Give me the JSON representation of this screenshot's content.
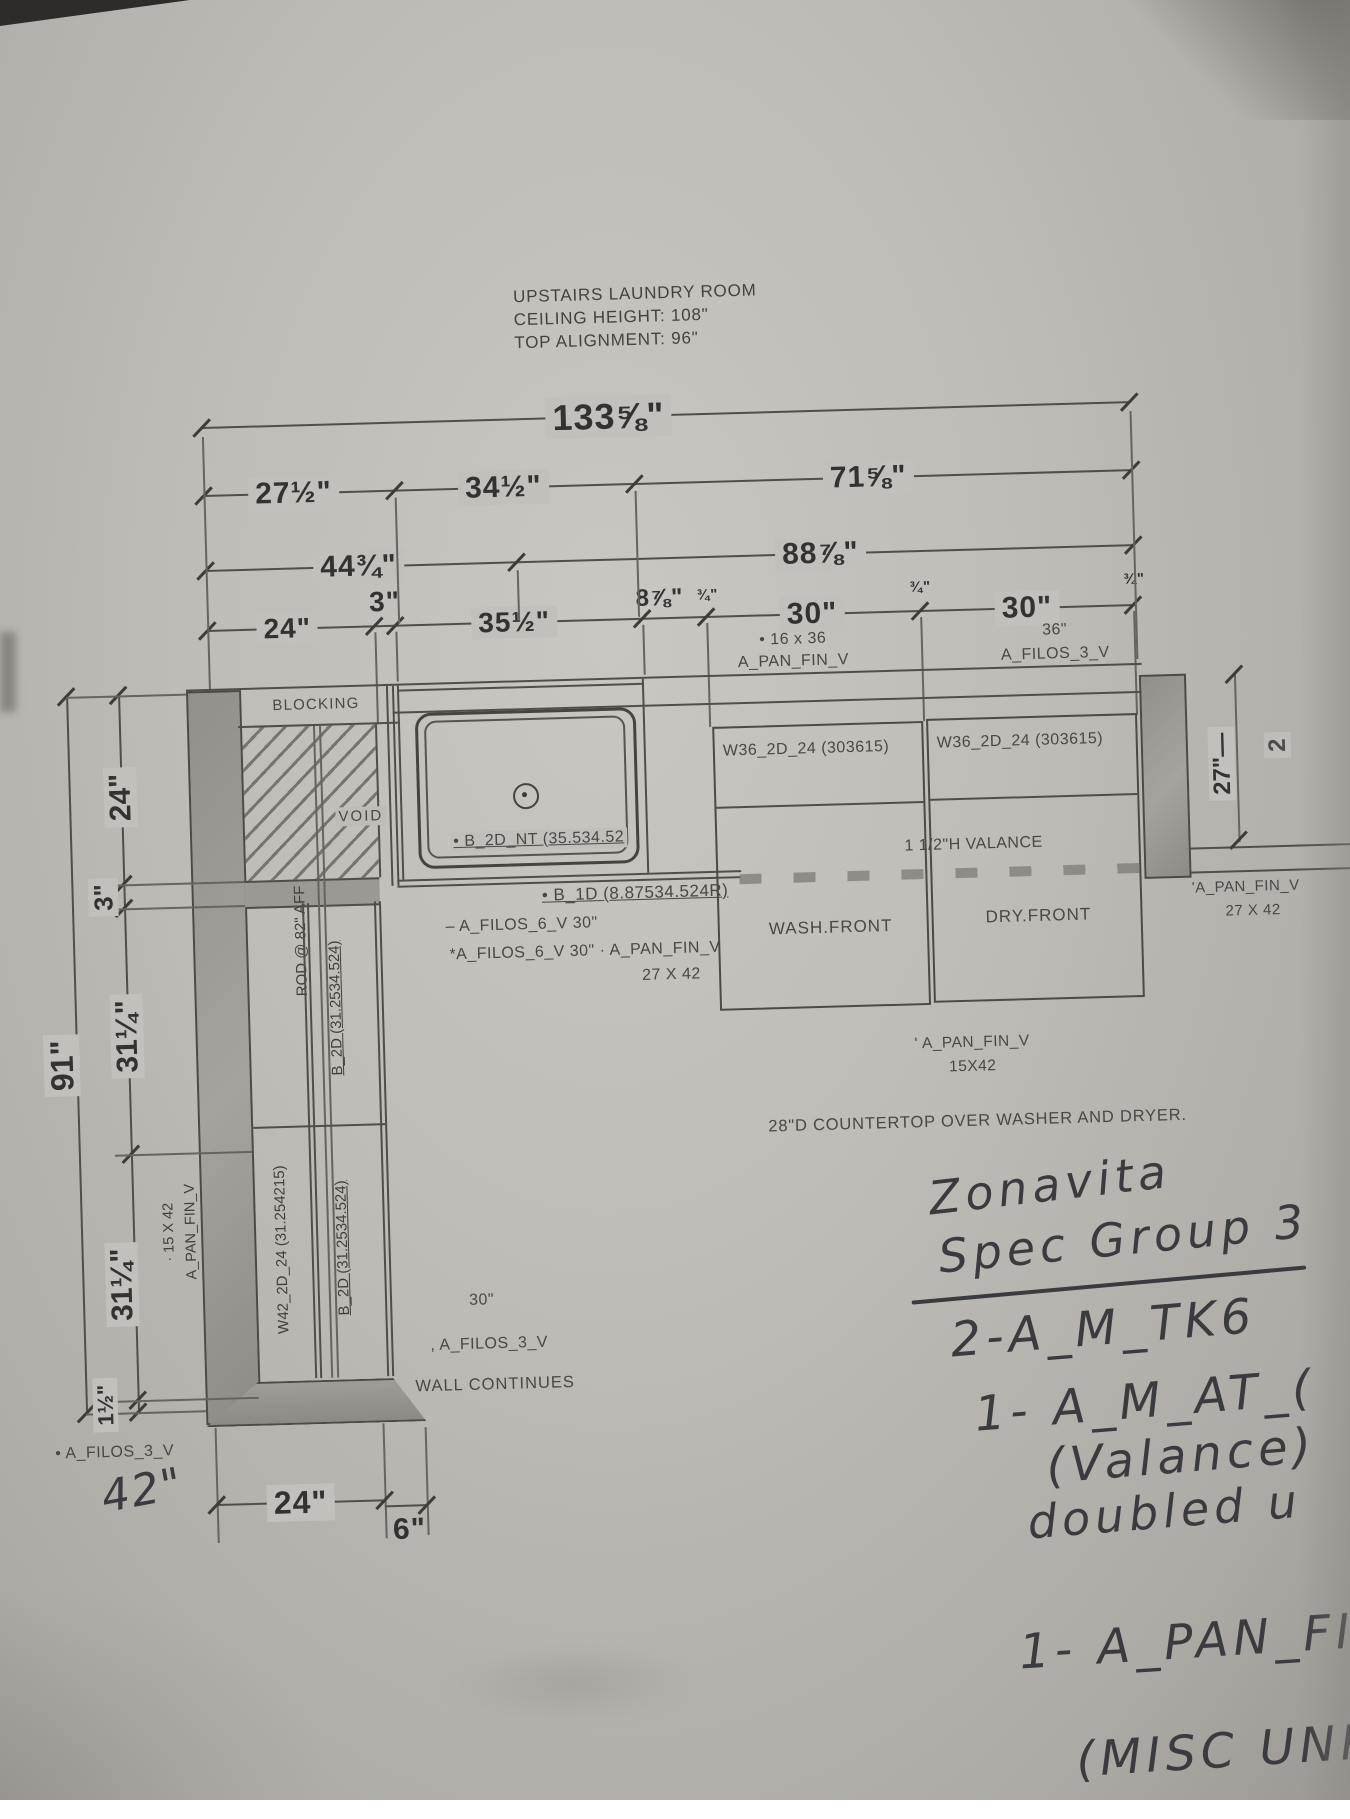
{
  "colors": {
    "paper": "#bfbcb7",
    "ink": "#45423e",
    "pencil": "#3a3a3f",
    "wall_fill": "#97938e"
  },
  "title_block": {
    "line1": "UPSTAIRS LAUNDRY ROOM",
    "line2": "CEILING HEIGHT: 108\"",
    "line3": "TOP ALIGNMENT: 96\""
  },
  "top_dims": {
    "overall": "133⅝\"",
    "row2": [
      "27½\"",
      "34½\"",
      "71⅝\""
    ],
    "row3": [
      "44¾\"",
      "88⅞\""
    ],
    "row4": [
      "24\"",
      "3\"",
      "35½\"",
      "8⅞\"",
      "¾\"",
      "30\"",
      "¾\"",
      "30\"",
      "¾\""
    ]
  },
  "top_labels": {
    "pan16x36_l1": "• 16 x 36",
    "pan16x36_l2": "A_PAN_FIN_V",
    "filos36_l1": "36\"",
    "filos36_l2": "A_FILOS_3_V"
  },
  "left_dims": {
    "d24": "24\"",
    "d3": "3\"",
    "d31a": "31¼\"",
    "d31b": "31¼\"",
    "d1_5": "1½\"",
    "d91": "91\"",
    "pan_l1": "· 15 X 42",
    "pan_l2": "A_PAN_FIN_V"
  },
  "bottom_dims": {
    "d24": "24\"",
    "d6": "6\""
  },
  "right_dims": {
    "d27": "27\"—",
    "fragment": "2"
  },
  "plan": {
    "blocking": "BLOCKING",
    "void": "VOID",
    "rod": "ROD @ 82\" AFF",
    "sink_cab": "• B_2D_NT (35.534.52",
    "base_right": "• B_1D (8.87534.524R)",
    "filos6_a": "– A_FILOS_6_V  30\"",
    "filos6_b": "*A_FILOS_6_V  30\" · A_PAN_FIN_V",
    "filos6_b2": "27 X 42",
    "wall_cab_left": "W36_2D_24 (303615)",
    "wall_cab_right": "W36_2D_24 (303615)",
    "valance": "1 1/2\"H VALANCE",
    "wash": "WASH.FRONT",
    "dry": "DRY.FRONT",
    "pan_mid_l1": "' A_PAN_FIN_V",
    "pan_mid_l2": "15X42",
    "countertop": "28\"D COUNTERTOP OVER WASHER AND DRYER.",
    "pan_right_l1": "'A_PAN_FIN_V",
    "pan_right_l2": "27 X 42",
    "tall_w42": "W42_2D_24 (31.254215)",
    "tall_b2d_upper": "B_2D (31.2534.524)",
    "tall_b2d_lower": "B_2D (31.2534.524)",
    "wall30": "30\"",
    "wall_filos": ", A_FILOS_3_V",
    "wall_continues": "WALL CONTINUES",
    "bottom_filos": "• A_FILOS_3_V"
  },
  "handwriting": {
    "h42": "42\"",
    "l1": "Zonavita",
    "l2": "Spec Group 3",
    "l3": "2-A_M_TK6",
    "l4": "1- A_M_AT_(",
    "l5": "(Valance)",
    "l6": "doubled    u",
    "l7": "1- A_PAN_FI",
    "l8": "(MISC UNP"
  }
}
